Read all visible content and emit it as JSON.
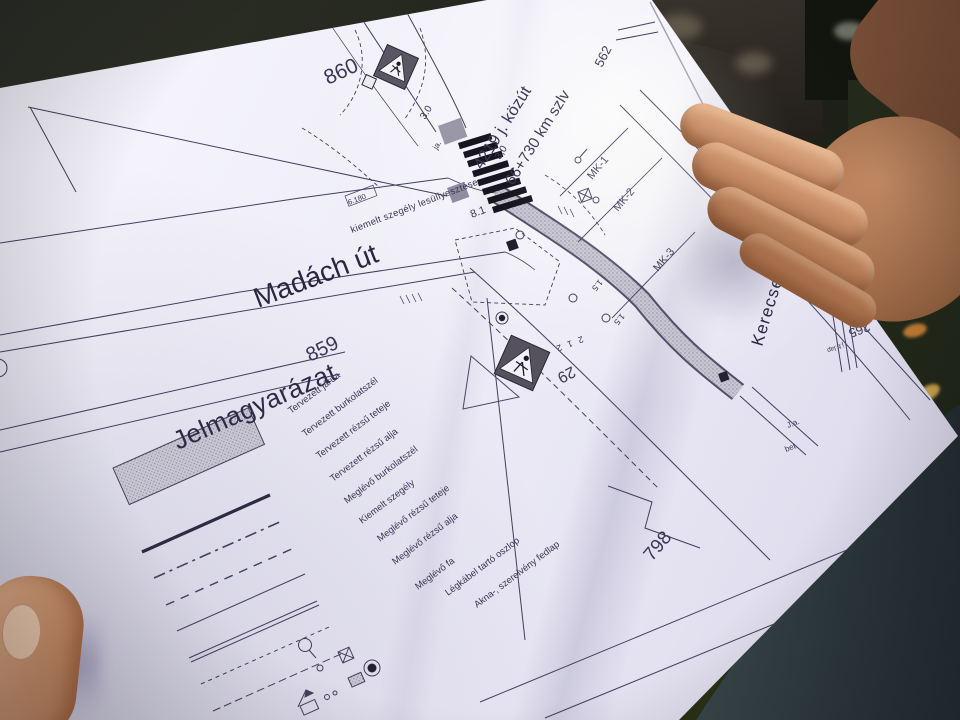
{
  "colors": {
    "ink": "#3c3553",
    "ink_heavy": "#1c1b26",
    "paper": "#efeef8",
    "sign_gray": "#55515f",
    "strip_gray": "#b7b3c4",
    "curb": "#9aa08d",
    "skin": "#c68d66",
    "sleeve": "#2c383c"
  },
  "plan": {
    "road": {
      "name": "4219 j. közút",
      "station": "66+730 km szlv"
    },
    "streets": {
      "madach": "Madách út",
      "kerecsenyi": "Kerecsenyi utca"
    },
    "parcels": {
      "p860": "860",
      "p859": "859",
      "p798": "798",
      "p562": "562",
      "p265": "265"
    },
    "sections": {
      "mk1": "MK-1",
      "mk2": "MK-2",
      "mk3": "MK-3"
    },
    "dimensions": {
      "w30_top": "3.0",
      "w30_mid": "3,0",
      "w81": "8.1",
      "w212": "2 1 2",
      "s15a": "1.5",
      "s15b": "1.5",
      "station_box": "6.180"
    },
    "notes": {
      "curb_note": "kiemelt szegély lesüllyesztése",
      "sign_no": "29",
      "ja1": "ja.",
      "ja2": "J.a.",
      "bet": "bet.",
      "jblap": "j.b.lap"
    },
    "legend": {
      "title": "Jelmagyarázat",
      "items": [
        "Tervezett járda",
        "Tervezett burkolatszél",
        "Tervezett rézsű teteje",
        "Tervezett rézsű alja",
        "Meglévő burkolatszél",
        "Kiemelt szegély",
        "Meglévő rézsű teteje",
        "Meglévő rézsű alja",
        "Meglévő fa",
        "Légkábel tartó oszlop",
        "Akna-, szerelvény fedlap"
      ]
    }
  }
}
